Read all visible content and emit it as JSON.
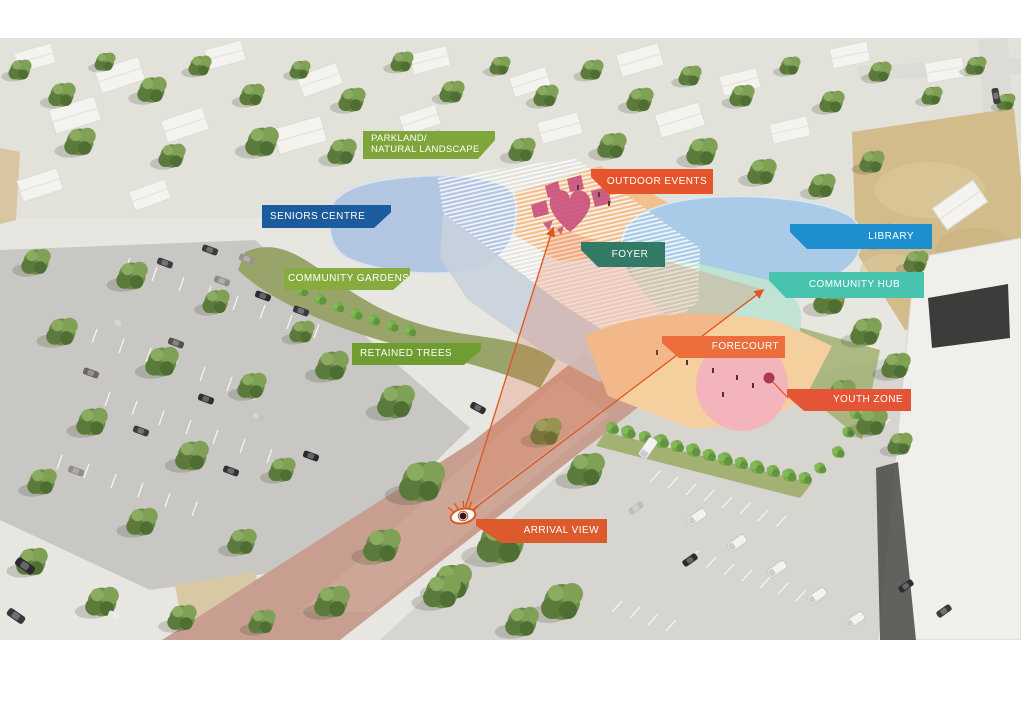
{
  "diagram": {
    "type": "aerial-site-plan-concept-render",
    "labels": {
      "parkland": {
        "line1": "PARKLAND/",
        "line2": "NATURAL LANDSCAPE",
        "color": "#7FA63B"
      },
      "seniors_centre": {
        "text": "SENIORS CENTRE",
        "color": "#1D5C9C"
      },
      "community_gardens": {
        "text": "COMMUNITY GARDENS",
        "color": "#86AC40"
      },
      "retained_trees": {
        "text": "RETAINED TREES",
        "color": "#6F9D31"
      },
      "outdoor_events": {
        "text": "OUTDOOR EVENTS",
        "color": "#E5542D"
      },
      "foyer": {
        "text": "FOYER",
        "color": "#337A66"
      },
      "library": {
        "text": "LIBRARY",
        "color": "#1E8FCE"
      },
      "community_hub": {
        "text": "COMMUNITY HUB",
        "color": "#47C3AE"
      },
      "forecourt": {
        "text": "FORECOURT",
        "color": "#ED6E3D"
      },
      "youth_zone": {
        "text": "YOUTH ZONE",
        "color": "#E45437"
      },
      "arrival_view": {
        "text": "ARRIVAL VIEW",
        "color": "#DC5A2B"
      }
    },
    "colors": {
      "heart_motif": "#C8517E",
      "view_cone_line": "#DF561F",
      "view_cone_fill": "rgba(232,106,58,0.22)",
      "seniors_roof": "#B3C6E1",
      "library_roof": "#AACBE7",
      "community_hub_roof": "#BFE4D4",
      "events_plaza": "#F2C08E",
      "forecourt_paving": "#F6CF9F",
      "youth_zone_surface": "#F3B4BC",
      "youth_marker": "#A93A52"
    }
  }
}
